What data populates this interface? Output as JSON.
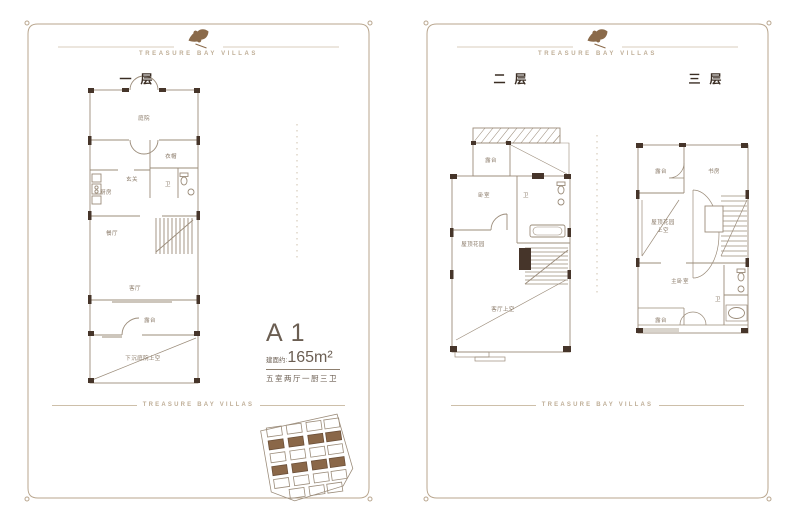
{
  "brand": {
    "tagline": "TREASURE BAY VILLAS"
  },
  "panels": {
    "left": {
      "floor1_title": "一层",
      "rooms": {
        "courtyard": "庭院",
        "cloak": "衣帽",
        "entry": "玄关",
        "kitchen": "厨房",
        "bath": "卫",
        "dining": "餐厅",
        "living": "客厅",
        "terrace": "露台",
        "sunken_void": "下沉庭院上空"
      },
      "unit": {
        "name": "A1",
        "area_label": "建面约:",
        "area_value": "165m²",
        "layout_desc": "五室两厅一厨三卫"
      }
    },
    "right": {
      "floor2_title": "二层",
      "floor2_rooms": {
        "terrace": "露台",
        "bedroom": "卧室",
        "bath": "卫",
        "roof_garden": "屋顶花园",
        "living_void": "客厅上空"
      },
      "floor3_title": "三层",
      "floor3_rooms": {
        "terrace_top": "露台",
        "study": "书房",
        "roof_void_line1": "屋顶花园",
        "roof_void_line2": "上空",
        "master_bedroom": "主卧室",
        "bath": "卫",
        "terrace_bottom": "露台"
      }
    }
  },
  "colors": {
    "frame": "#b9a68e",
    "wall_fill": "#46352a",
    "plan_line": "#9b8c7a",
    "label": "#8a7a68",
    "title": "#3a2d23",
    "accent_text": "#6b5e52",
    "tagline": "#bfae97",
    "map_fill": "#8a6748"
  }
}
